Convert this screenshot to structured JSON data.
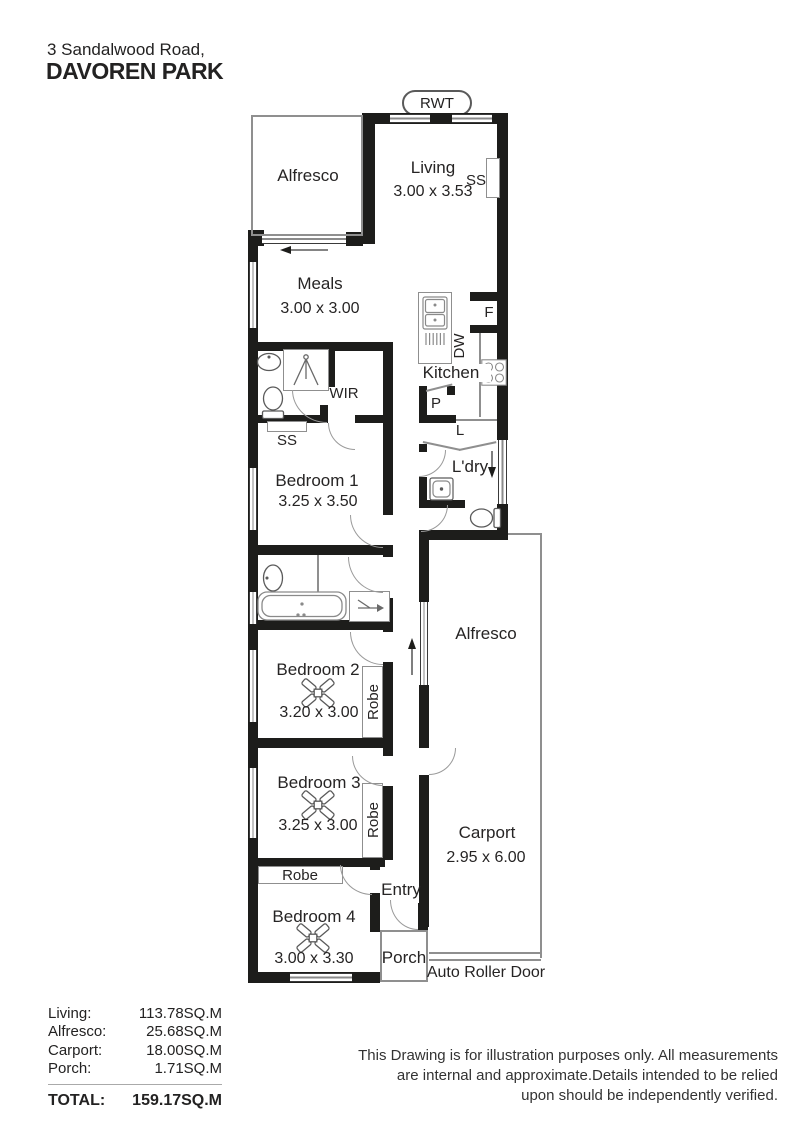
{
  "header": {
    "address_line1": "3 Sandalwood Road,",
    "address_line2": "DAVOREN PARK"
  },
  "plan": {
    "rwt_label": "RWT",
    "rooms": {
      "alfresco_top": {
        "name": "Alfresco"
      },
      "living": {
        "name": "Living",
        "dims": "3.00 x 3.53"
      },
      "meals": {
        "name": "Meals",
        "dims": "3.00 x 3.00"
      },
      "kitchen": {
        "name": "Kitchen"
      },
      "wir": {
        "name": "WIR"
      },
      "bedroom1": {
        "name": "Bedroom 1",
        "dims": "3.25 x 3.50"
      },
      "bedroom2": {
        "name": "Bedroom 2",
        "dims": "3.20 x 3.00"
      },
      "bedroom3": {
        "name": "Bedroom 3",
        "dims": "3.25 x 3.00"
      },
      "bedroom4": {
        "name": "Bedroom 4",
        "dims": "3.00 x 3.30"
      },
      "laundry": {
        "name": "L'dry"
      },
      "linen": {
        "name": "L"
      },
      "pantry": {
        "name": "P"
      },
      "fridge": {
        "name": "F"
      },
      "dishwasher": {
        "name": "DW"
      },
      "entry": {
        "name": "Entry"
      },
      "porch": {
        "name": "Porch"
      },
      "alfresco_right": {
        "name": "Alfresco"
      },
      "carport": {
        "name": "Carport",
        "dims": "2.95 x 6.00"
      }
    },
    "labels": {
      "ss_living": "SS",
      "ss_ensuite": "SS",
      "robe_bed2": "Robe",
      "robe_bed3": "Robe",
      "robe_bed4": "Robe",
      "auto_roller_door": "Auto Roller Door"
    },
    "icons": [
      "ceiling-fan-icon",
      "toilet-icon",
      "sink-icon",
      "bathtub-icon",
      "shower-icon",
      "kitchen-sink-icon",
      "cooktop-icon",
      "laundry-tub-icon",
      "arrow-icon"
    ]
  },
  "areas": {
    "rows": [
      {
        "label": "Living:",
        "value": "113.78SQ.M"
      },
      {
        "label": "Alfresco:",
        "value": "25.68SQ.M"
      },
      {
        "label": "Carport:",
        "value": "18.00SQ.M"
      },
      {
        "label": "Porch:",
        "value": "1.71SQ.M"
      }
    ],
    "total": {
      "label": "TOTAL:",
      "value": "159.17SQ.M"
    }
  },
  "disclaimer": {
    "lines": [
      "This Drawing is for illustration purposes only. All measurements",
      "are internal and approximate.Details intended to be relied",
      "upon should be independently verified."
    ]
  },
  "colors": {
    "wall": "#1d1d1b",
    "thin_line": "#8f8f8f",
    "text": "#232222"
  }
}
